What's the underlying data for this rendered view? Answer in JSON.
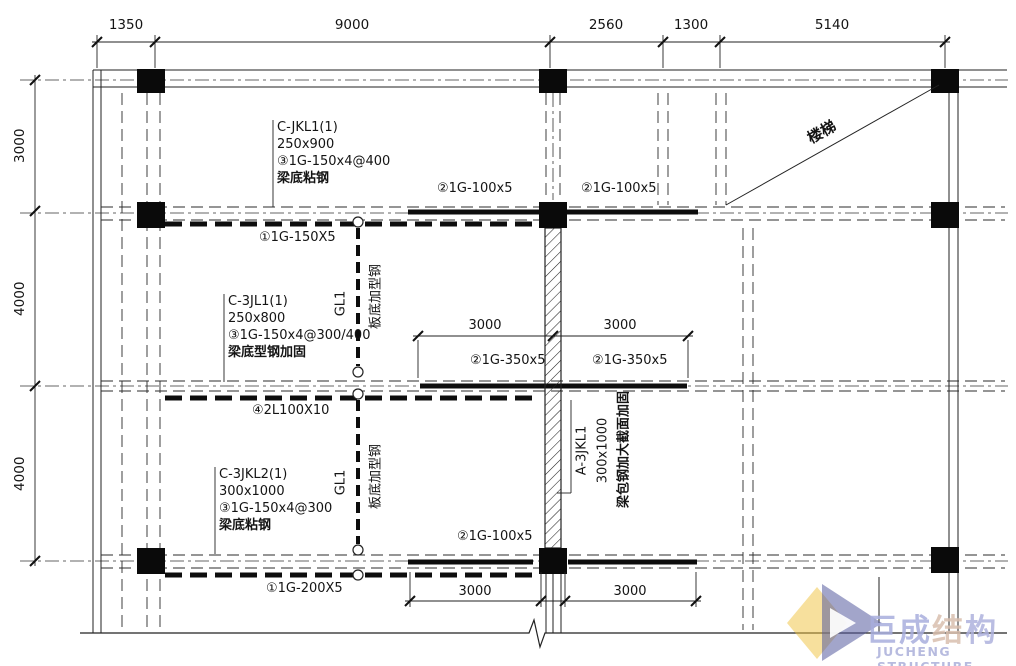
{
  "dims": {
    "top": [
      "1350",
      "9000",
      "2560",
      "1300",
      "5140"
    ],
    "left": [
      "3000",
      "4000",
      "4000"
    ],
    "mid": [
      "3000",
      "3000"
    ],
    "bottom": [
      "3000",
      "3000"
    ]
  },
  "labels": {
    "jkl1": {
      "l1": "C-JKL1(1)",
      "l2": "250x900",
      "l3": "③1G-150x4@400",
      "note": "梁底粘钢"
    },
    "jl1": {
      "l1": "C-3JL1(1)",
      "l2": "250x800",
      "l3": "③1G-150x4@300/400",
      "note": "梁底型钢加固"
    },
    "jkl2": {
      "l1": "C-3JKL2(1)",
      "l2": "300x1000",
      "l3": "③1G-150x4@300",
      "note": "梁底粘钢"
    },
    "a3jkl1": {
      "l1": "A-3JKL1",
      "l2": "300x1000",
      "note": "梁包钢加大截面加固"
    },
    "r2_plate_left": "②1G-100x5",
    "r2_plate_right": "②1G-100x5",
    "r2_beam": "①1G-150X5",
    "r3_plate_left": "②1G-350x5",
    "r3_plate_right": "②1G-350x5",
    "r3_beam": "④2L100X10",
    "r4_plate": "②1G-100x5",
    "r4_beam": "①1G-200X5",
    "gl1_upper": "GL1",
    "gl1_lower": "GL1",
    "slab_note_upper": "板底加型钢",
    "slab_note_lower": "板底加型钢",
    "stair": "楼梯"
  },
  "logo": {
    "cn_a": "巨成",
    "cn_b": "结",
    "cn_c": "构",
    "en": "JUCHENG STRUCTURE",
    "accent_yellow": "#f0c23c",
    "accent_blue": "#565b9f",
    "text_blue": "#a9aedd",
    "text_warm": "#d9bfae"
  }
}
